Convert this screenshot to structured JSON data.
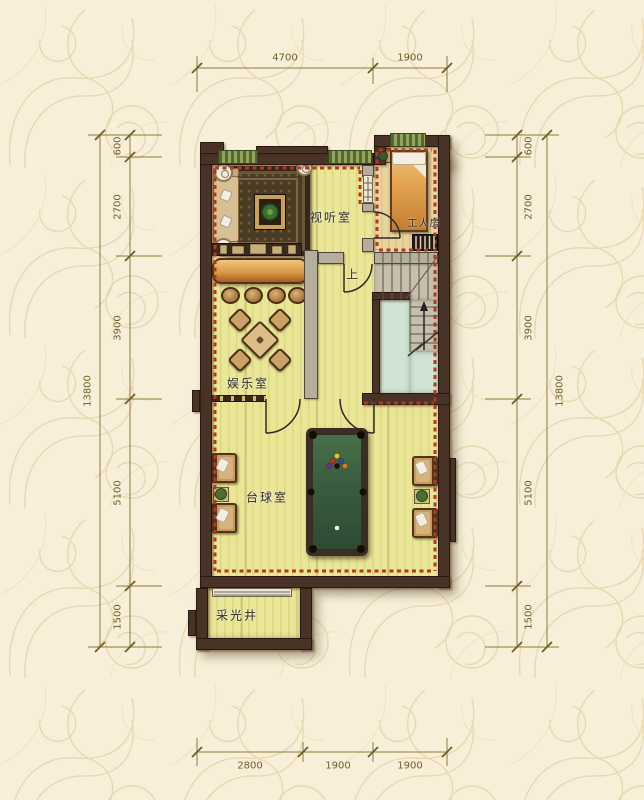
{
  "rooms": {
    "av_room": "视听室",
    "worker_room": "工人房",
    "entertainment_room": "娱乐室",
    "billiards_room": "台球室",
    "light_well": "采光井",
    "stair_direction": "上"
  },
  "dimensions": {
    "top": [
      "4700",
      "1900"
    ],
    "bottom": [
      "2800",
      "1900",
      "1900"
    ],
    "left": [
      "600",
      "2700",
      "3900",
      "5100",
      "1500"
    ],
    "left_total": "13800",
    "right": [
      "600",
      "2700",
      "3900",
      "5100",
      "1500"
    ],
    "right_total": "13800"
  },
  "colors": {
    "background": "#f7efd8",
    "ornament": "#e8d8b3",
    "dimension_line": "#8d7b40",
    "wall": "#493226",
    "floor": "#eae697",
    "insulation_dash": "#b33822",
    "window_green": "#7d8f4a",
    "stair_void": "#cfe2d4",
    "pool_felt": "#3f5e42"
  }
}
